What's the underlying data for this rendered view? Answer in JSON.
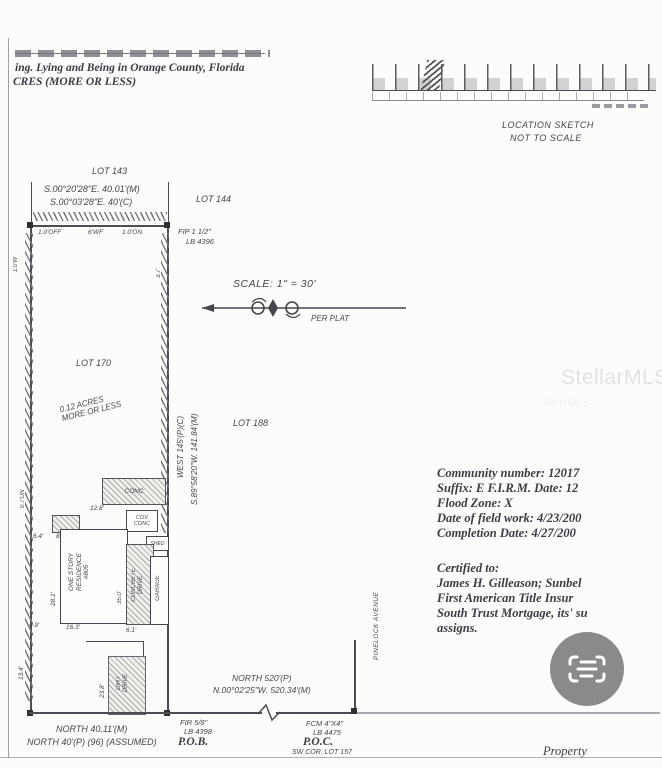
{
  "colors": {
    "ink": "#45454e",
    "paper": "#fcfcfa",
    "badge_gray": "#8a8a8a",
    "watermark": "#e2e2e6"
  },
  "header": {
    "line1": "ing. Lying and Being in Orange County, Florida",
    "line2": "CRES (MORE OR LESS)"
  },
  "location_sketch": {
    "title_line1": "LOCATION SKETCH",
    "title_line2": "NOT TO SCALE"
  },
  "scale_note": {
    "label": "SCALE:  1\" = 30'",
    "per_plat": "PER PLAT"
  },
  "lots": {
    "lot_143": "LOT 143",
    "lot_144": "LOT 144",
    "lot_170": "LOT 170",
    "lot_188": "LOT 188",
    "acreage_line1": "0.12 ACRES",
    "acreage_line2": "MORE OR LESS"
  },
  "bearings": {
    "top_measured": "S.00°20'28\"E.  40.01'(M)",
    "top_calc": "S.00°03'28\"E.  40'(C)",
    "east_plat": "WEST  145'(P)(C)",
    "east_measured": "S.89°58'20\"W.  141.84'(M)",
    "south_measured": "NORTH  40.11'(M)",
    "south_plat": "NORTH 40'(P) (96) (ASSUMED)",
    "street_plat": "NORTH  520'(P)",
    "street_measured": "N.00°02'25\"W.  520.34'(M)"
  },
  "monuments": {
    "fip_line1": "FIP 1 1/2\"",
    "fip_line2": "LB 4396",
    "fir_line1": "FIR 5/8\"",
    "fir_line2": "LB 4398",
    "pob": "P.O.B.",
    "fcm_line1": "FCM 4\"X4\"",
    "fcm_line2": "LB 4475",
    "poc": "P.O.C.",
    "poc_corner": "SW COR. LOT 157"
  },
  "street": {
    "name": "PINELOCK AVENUE"
  },
  "fence_notes": {
    "off": "1.0'OFF",
    "wf": "6'WF",
    "on": "1.0'ON",
    "west": "1.0'W",
    "on2": "0.7'ON",
    "gap": "3.7'"
  },
  "structures": {
    "conc": "CONC",
    "cov_line1": "COV",
    "cov_line2": "CONC",
    "shed": "SHED",
    "res_line1": "ONE STORY",
    "res_line2": "RESIDENCE",
    "res_line3": "#805",
    "drive_line1": "CONCRETE",
    "drive_line2": "DRIVE",
    "garage": "GARAGE",
    "dirt_line1": "DIRT",
    "dirt_line2": "DRIVE"
  },
  "dims": {
    "a": "12.8'",
    "b": "6.4'",
    "c": "8.3'",
    "d": "28.1'",
    "e": "35.0'",
    "f": "4.9'",
    "g": "16.3'",
    "h": "6.1'",
    "i": "23.8'",
    "j": "13.4'"
  },
  "flood_info": {
    "l1": "Community number: 12017",
    "l2": "Suffix: E F.I.R.M. Date: 12",
    "l3": "Flood Zone: X",
    "l4": "Date of field work: 4/23/200",
    "l5": "Completion Date: 4/27/200"
  },
  "certified": {
    "l1": "Certified to:",
    "l2": "James H. Gilleason; Sunbel",
    "l3": "First American Title Insur",
    "l4": "South Trust Mortgage, its' su",
    "l5": "assigns."
  },
  "watermark": {
    "main": "StellarMLS",
    "secondary": "MFRMLS"
  },
  "footer": {
    "property": "Property"
  },
  "icons": {
    "badge": "document-scan-icon",
    "north_arrow": "north-arrow-icon"
  }
}
